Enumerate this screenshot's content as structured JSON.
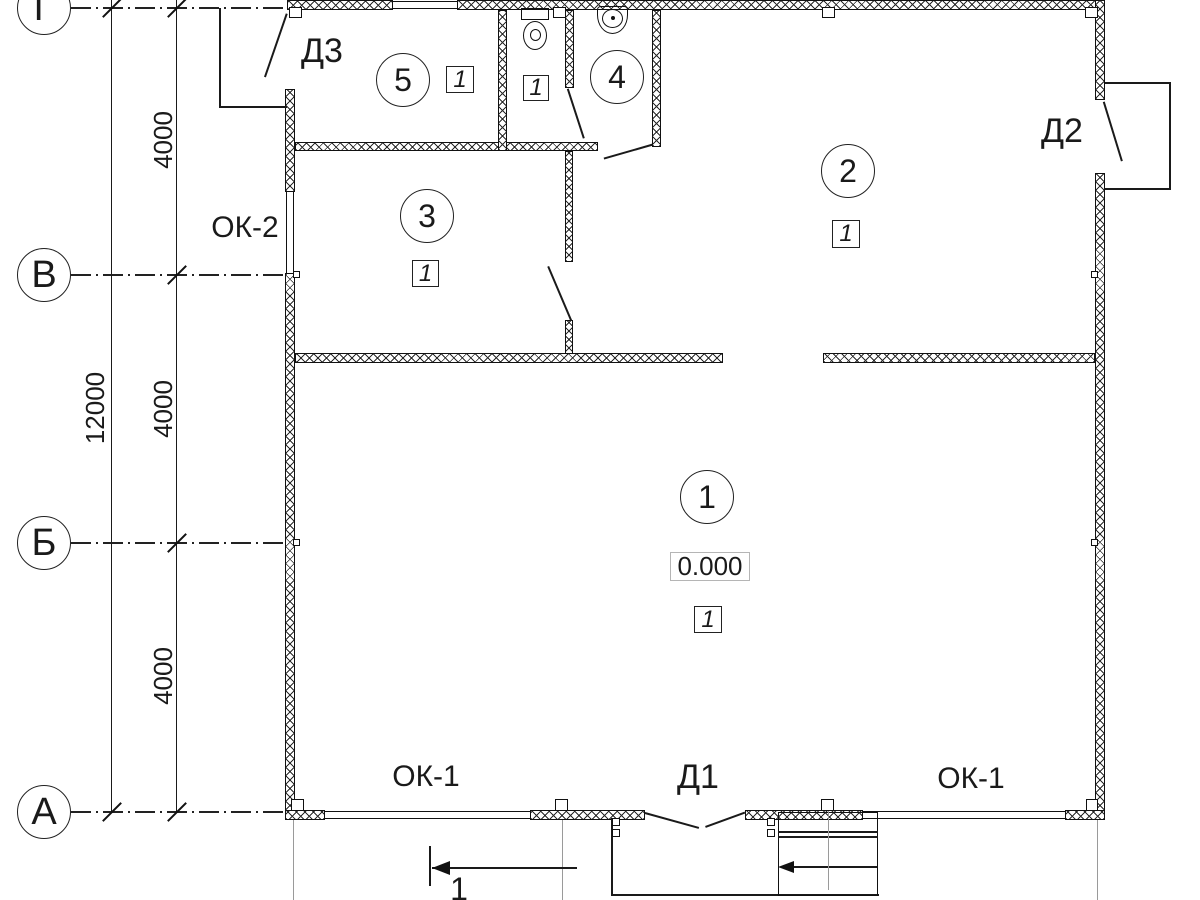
{
  "axes": [
    {
      "label": "Г"
    },
    {
      "label": "В"
    },
    {
      "label": "Б"
    },
    {
      "label": "А"
    }
  ],
  "dims": {
    "overall": "12000",
    "seg1": "4000",
    "seg2": "4000",
    "seg3": "4000"
  },
  "rooms": [
    {
      "number": "1",
      "mark": "1"
    },
    {
      "number": "2",
      "mark": "1"
    },
    {
      "number": "3",
      "mark": "1"
    },
    {
      "number": "4"
    },
    {
      "number": "5",
      "mark": "1"
    }
  ],
  "wc_mark": "1",
  "level": "0.000",
  "doors": {
    "d1": "Д1",
    "d2": "Д2",
    "d3": "Д3"
  },
  "windows": {
    "ok1": "ОК-1",
    "ok2": "ОК-2"
  },
  "section": {
    "label": "1"
  }
}
